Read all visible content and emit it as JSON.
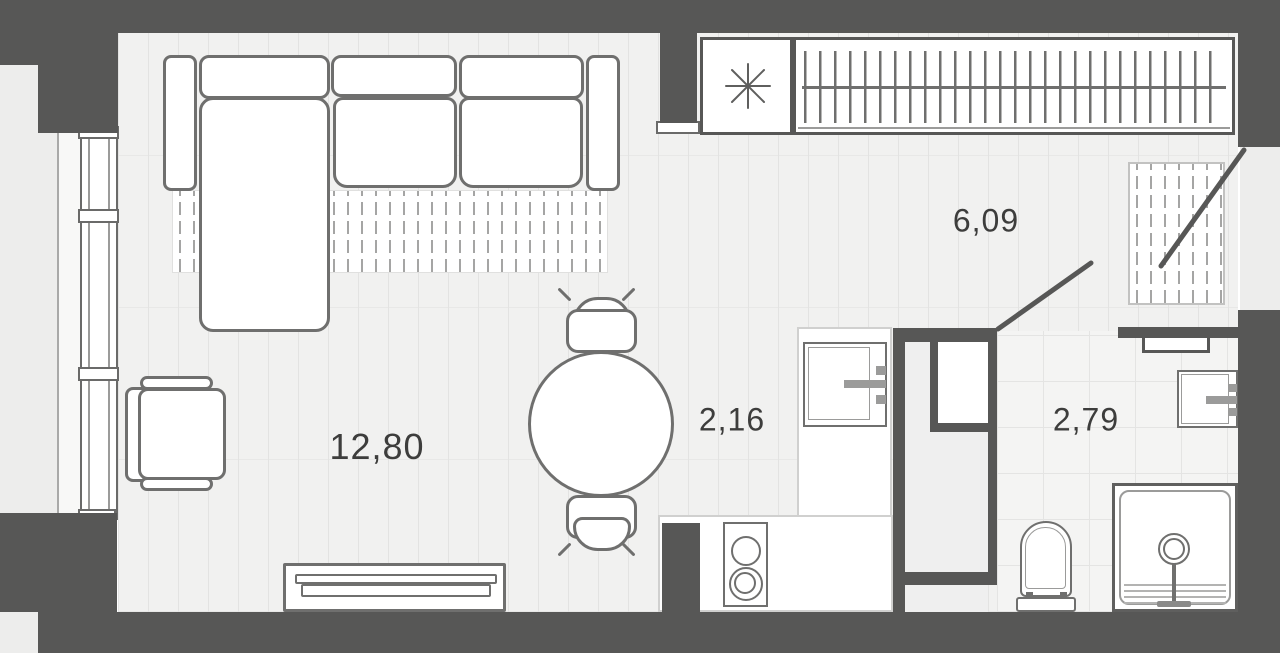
{
  "plan": {
    "rooms": [
      {
        "name": "living-room",
        "area": "12,80"
      },
      {
        "name": "kitchen-zone",
        "area": "2,16"
      },
      {
        "name": "hallway",
        "area": "6,09"
      },
      {
        "name": "bathroom",
        "area": "2,79"
      }
    ],
    "icons": {
      "utility_marker": "eight-spoke-asterisk",
      "wardrobe_rail": "hanger-rail"
    },
    "colors": {
      "wall": "#575756",
      "outline": "#6f6f6e",
      "floor": "#f1f1f0",
      "tile": "#f4f4f3",
      "exterior": "#ededec",
      "label": "#3d3d3c"
    }
  }
}
